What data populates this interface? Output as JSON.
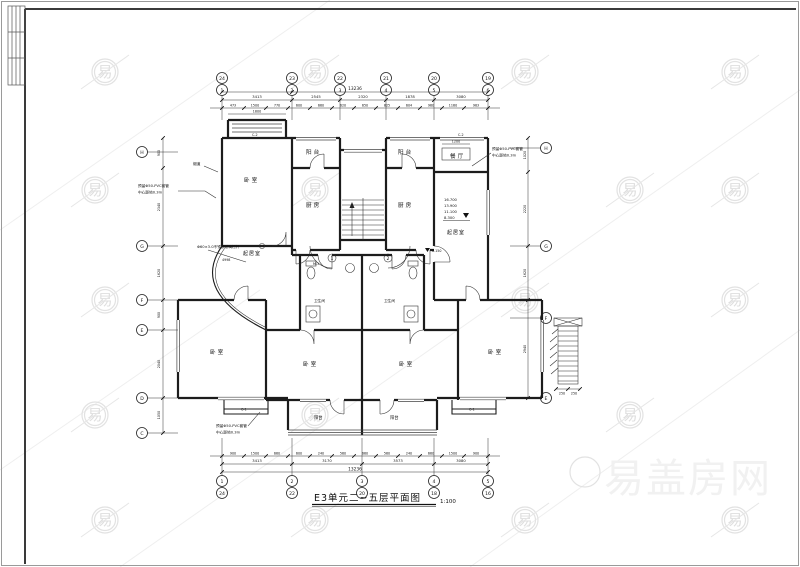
{
  "watermark": {
    "char": "易",
    "logo": "易盖房网"
  },
  "title": {
    "text": "E3单元二~五层平面图",
    "scale": "1:100"
  },
  "grid": {
    "top_upper": [
      "24",
      "23",
      "22",
      "21",
      "20",
      "19"
    ],
    "top_lower": [
      "1",
      "2",
      "3",
      "4",
      "5",
      "6"
    ],
    "bottom_upper": [
      "1",
      "2",
      "3",
      "4",
      "5"
    ],
    "bottom_lower": [
      "24",
      "22",
      "20",
      "18",
      "16"
    ],
    "left": [
      "H",
      "G",
      "F",
      "E",
      "D",
      "C"
    ],
    "right": [
      "H",
      "G",
      "F",
      "E"
    ]
  },
  "dims": {
    "top_total": "13236",
    "top_spans": [
      "3413",
      "2545",
      "2320",
      "1878",
      "3080"
    ],
    "top_segs": [
      "473",
      "1500",
      "770",
      "600",
      "660",
      "620",
      "650",
      "825",
      "604",
      "960",
      "1160",
      "983"
    ],
    "bottom_total": "13236",
    "bottom_spans": [
      "3413",
      "3170",
      "3573",
      "3080"
    ],
    "bottom_segs": [
      "900",
      "1500",
      "660",
      "600",
      "240",
      "560",
      "660",
      "560",
      "240",
      "660",
      "1500",
      "900"
    ],
    "left_spans": [
      "900",
      "2340",
      "1620",
      "900",
      "2040",
      "1050"
    ],
    "right_spans": [
      "1020",
      "2220",
      "1620",
      "2940"
    ],
    "bay_width": "1800",
    "closet_width": "1200",
    "detail_step": "250",
    "railing_len": "4998"
  },
  "rooms": {
    "bedroom": "卧室",
    "balcony": "阳台",
    "kitchen": "厨房",
    "living": "起居室",
    "bath": "卫生间",
    "dining": "餐厅"
  },
  "notes": {
    "pvc1": "预留Φ50-PVC套管",
    "pvc2": "中心距地0.3m",
    "railing": "Φ60×3.0不锈钢玻璃栏杆",
    "flue": "烟道",
    "levels": [
      "16.700",
      "13.900",
      "11.100",
      "8.300"
    ],
    "entry_level": "0.150",
    "unit1": "1",
    "unit2": "2",
    "win_c1": "C-1",
    "win_c2": "C-2",
    "door_m1": "M-1"
  }
}
